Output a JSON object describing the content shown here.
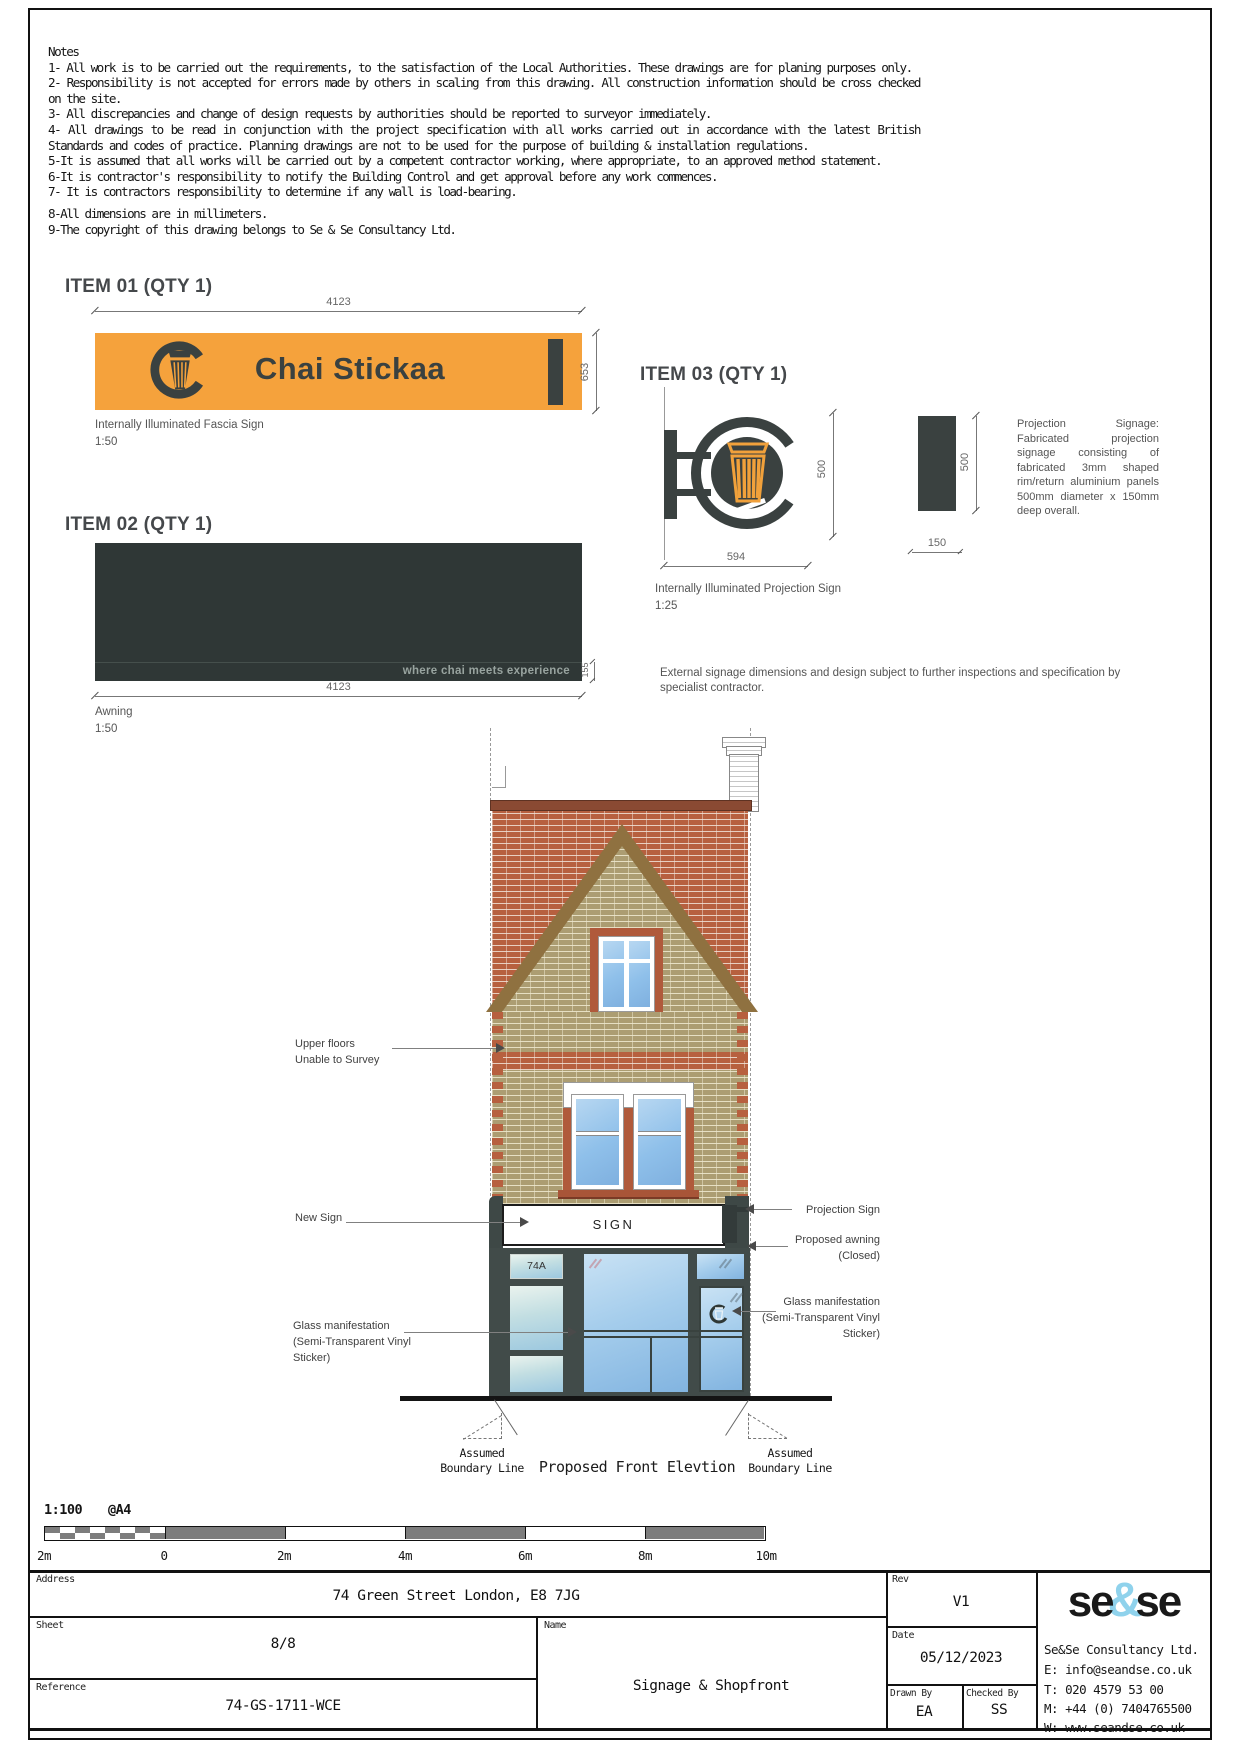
{
  "notes": {
    "title": "Notes",
    "items": [
      "1- All work is to be carried out the requirements, to the satisfaction of the Local Authorities. These drawings are for planing purposes only.",
      "2- Responsibility is not accepted for errors made by others in scaling from this drawing. All construction information should be cross checked on the site.",
      "3- All discrepancies and change of design requests by authorities should be reported to surveyor immediately.",
      "4- All drawings to be read in conjunction with the project specification with all works carried out in accordance with the latest British Standards and codes of practice. Planning drawings are not to be used for the purpose of building & installation regulations.",
      "5-It is assumed that all works will be carried out by a competent contractor working, where appropriate, to an approved method statement.",
      "6-It is contractor's responsibility to notify the Building Control and get approval before any work commences.",
      "7- It is contractors responsibility to determine if any wall is load-bearing.",
      "8-All dimensions are in millimeters.",
      "9-The copyright of this drawing belongs to Se & Se Consultancy Ltd."
    ]
  },
  "item01": {
    "heading": "ITEM 01 (QTY 1)",
    "brand": "Chai Stickaa",
    "dim_width": "4123",
    "dim_height": "653",
    "caption": "Internally Illuminated Fascia Sign",
    "scale": "1:50"
  },
  "item02": {
    "heading": "ITEM 02 (QTY 1)",
    "tagline": "where chai meets experience",
    "dim_width": "4123",
    "dim_strip": "155",
    "caption": "Awning",
    "scale": "1:50"
  },
  "item03": {
    "heading": "ITEM 03 (QTY 1)",
    "dim_circle": "500",
    "dim_width": "594",
    "dim_side_h": "500",
    "dim_side_w": "150",
    "caption": "Internally Illuminated Projection Sign",
    "scale": "1:25",
    "spec": "Projection Signage: Fabricated projection signage consisting of fabricated 3mm shaped rim/return aluminium panels 500mm diameter x 150mm deep overall."
  },
  "external_note": "External signage dimensions and design subject to further inspections and specification by specialist contractor.",
  "elevation": {
    "title": "Proposed Front Elevtion",
    "fascia_text": "SIGN",
    "door_number": "74A",
    "left_labels": {
      "upper": [
        "Upper floors",
        "Unable to Survey"
      ],
      "new_sign": [
        "New Sign"
      ],
      "glass": [
        "Glass manifestation",
        "(Semi-Transparent Vinyl",
        "Sticker)"
      ]
    },
    "right_labels": {
      "projection": [
        "Projection Sign"
      ],
      "awning": [
        "Proposed awning",
        "(Closed)"
      ],
      "glass": [
        "Glass manifestation",
        "(Semi-Transparent Vinyl",
        "Sticker)"
      ]
    },
    "boundary_left": [
      "Assumed",
      "Boundary Line"
    ],
    "boundary_right": [
      "Assumed",
      "Boundary Line"
    ]
  },
  "scalebar": {
    "scale": "1:100",
    "paper": "@A4",
    "ticks": [
      "2m",
      "0",
      "2m",
      "4m",
      "6m",
      "8m",
      "10m"
    ]
  },
  "titleblock": {
    "address_label": "Address",
    "address": "74 Green Street London, E8 7JG",
    "sheet_label": "Sheet",
    "sheet": "8/8",
    "reference_label": "Reference",
    "reference": "74-GS-1711-WCE",
    "name_label": "Name",
    "name": "Signage & Shopfront",
    "rev_label": "Rev",
    "rev": "V1",
    "date_label": "Date",
    "date": "05/12/2023",
    "drawn_label": "Drawn By",
    "drawn": "EA",
    "checked_label": "Checked By",
    "checked": "SS",
    "logo": {
      "part1": "se",
      "amp": "&",
      "part2": "se"
    },
    "company": "Se&Se Consultancy Ltd.",
    "email": "E: info@seandse.co.uk",
    "phone": "T: 020 4579 53 00",
    "mobile": "M: +44 (0) 7404765500",
    "web": "W: www.seandse.co.uk"
  },
  "colors": {
    "accent_orange": "#F5A23C",
    "dark_slate": "#3A4140",
    "awning_dark": "#2F3736",
    "brick_red": "#B7603F",
    "brick_tan": "#AC9D72",
    "logo_blue": "#8FD2EC"
  }
}
